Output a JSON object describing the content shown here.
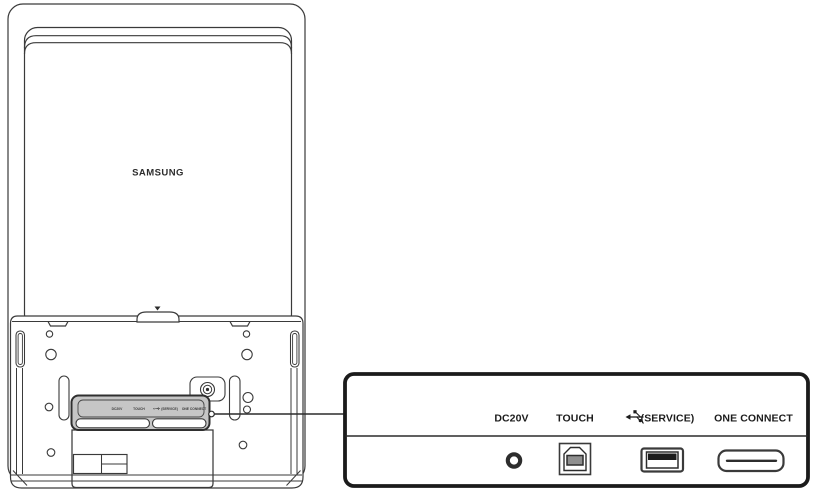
{
  "monitor": {
    "brand": "SAMSUNG"
  },
  "ports": [
    {
      "id": "dc20v",
      "label": "DC20V",
      "icon": "dc-jack-icon"
    },
    {
      "id": "touch",
      "label": "TOUCH",
      "icon": "usb-b-port-icon"
    },
    {
      "id": "usb_service",
      "label": "(SERVICE)",
      "icon": "usb-a-port-icon",
      "label_icon": "usb-symbol-icon"
    },
    {
      "id": "one_connect",
      "label": "ONE CONNECT",
      "icon": "one-connect-port-icon"
    }
  ],
  "colors": {
    "line": "#3a3a3a",
    "panel_border": "#1b1b1b",
    "recess_fill": "#c6c6c6",
    "port_inner_fill": "#8f8f8f",
    "usb_bar_fill": "#1c1c1c",
    "background": "#ffffff"
  }
}
